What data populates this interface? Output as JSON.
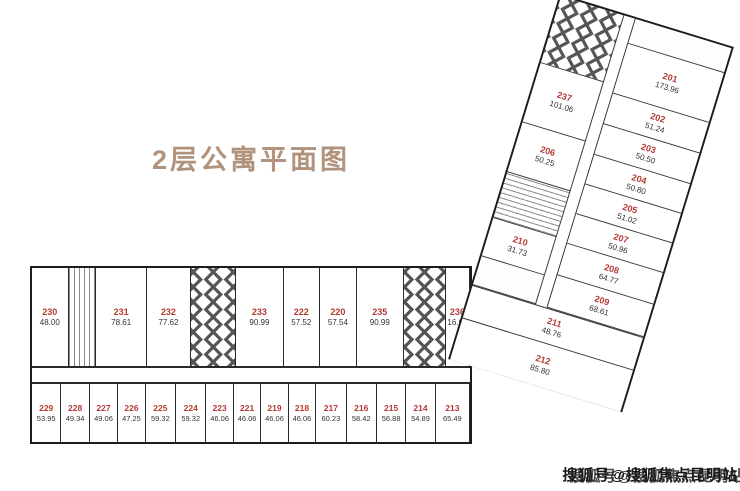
{
  "title": "2层公寓平面图",
  "watermark": "搜狐号@搜狐焦点昆明站",
  "colors": {
    "title": "#b1927c",
    "room_number": "#b23b34",
    "area_text": "#333333",
    "wall": "#1c1c1c"
  },
  "main_block": {
    "upper_row": [
      {
        "kind": "room",
        "number": "230",
        "area": "48.00",
        "w": 40
      },
      {
        "kind": "stairs",
        "w": 30
      },
      {
        "kind": "room",
        "number": "231",
        "area": "78.61",
        "w": 56
      },
      {
        "kind": "room",
        "number": "232",
        "area": "77.62",
        "w": 48
      },
      {
        "kind": "core",
        "w": 50
      },
      {
        "kind": "room",
        "number": "233",
        "area": "90.99",
        "w": 52
      },
      {
        "kind": "room",
        "number": "222",
        "area": "57.52",
        "w": 40
      },
      {
        "kind": "room",
        "number": "220",
        "area": "57.54",
        "w": 40
      },
      {
        "kind": "room",
        "number": "235",
        "area": "90.99",
        "w": 52
      },
      {
        "kind": "core",
        "w": 46
      },
      {
        "kind": "room",
        "number": "236",
        "area": "16.61",
        "w": 26
      }
    ],
    "lower_row": [
      {
        "kind": "room",
        "number": "229",
        "area": "53.95",
        "w": 29
      },
      {
        "kind": "room",
        "number": "228",
        "area": "49.34",
        "w": 28
      },
      {
        "kind": "room",
        "number": "227",
        "area": "49.06",
        "w": 28
      },
      {
        "kind": "room",
        "number": "226",
        "area": "47.25",
        "w": 27
      },
      {
        "kind": "room",
        "number": "225",
        "area": "59.32",
        "w": 30
      },
      {
        "kind": "room",
        "number": "224",
        "area": "59.32",
        "w": 30
      },
      {
        "kind": "room",
        "number": "223",
        "area": "46.06",
        "w": 27
      },
      {
        "kind": "room",
        "number": "221",
        "area": "46.06",
        "w": 27
      },
      {
        "kind": "room",
        "number": "219",
        "area": "46.06",
        "w": 27
      },
      {
        "kind": "room",
        "number": "218",
        "area": "46.06",
        "w": 27
      },
      {
        "kind": "room",
        "number": "217",
        "area": "60.23",
        "w": 30
      },
      {
        "kind": "room",
        "number": "216",
        "area": "58.42",
        "w": 30
      },
      {
        "kind": "room",
        "number": "215",
        "area": "56.88",
        "w": 29
      },
      {
        "kind": "room",
        "number": "214",
        "area": "54.89",
        "w": 29
      },
      {
        "kind": "room",
        "number": "213",
        "area": "65.49",
        "w": 34
      }
    ]
  },
  "wing": {
    "left_column": [
      {
        "kind": "core",
        "h": 70
      },
      {
        "kind": "room",
        "number": "237",
        "area": "101.06",
        "h": 62
      },
      {
        "kind": "room",
        "number": "206",
        "area": "50.25",
        "h": 52
      },
      {
        "kind": "stairs",
        "h": 48
      },
      {
        "kind": "room",
        "number": "210",
        "area": "31.73",
        "h": 40
      },
      {
        "kind": "svc",
        "h": 30
      }
    ],
    "right_column": [
      {
        "kind": "svc",
        "h": 26
      },
      {
        "kind": "room",
        "number": "201",
        "area": "173.96",
        "h": 52
      },
      {
        "kind": "room",
        "number": "202",
        "area": "51.24",
        "h": 32
      },
      {
        "kind": "room",
        "number": "203",
        "area": "50.50",
        "h": 32
      },
      {
        "kind": "room",
        "number": "204",
        "area": "50.80",
        "h": 31
      },
      {
        "kind": "room",
        "number": "205",
        "area": "51.02",
        "h": 31
      },
      {
        "kind": "room",
        "number": "207",
        "area": "50.96",
        "h": 31
      },
      {
        "kind": "room",
        "number": "208",
        "area": "64.77",
        "h": 33
      },
      {
        "kind": "room",
        "number": "209",
        "area": "68.61",
        "h": 34
      }
    ],
    "bottom_rooms": [
      {
        "kind": "room",
        "number": "211",
        "area": "48.76",
        "h": 34
      },
      {
        "kind": "room",
        "number": "212",
        "area": "85.80",
        "h": 44
      }
    ]
  }
}
